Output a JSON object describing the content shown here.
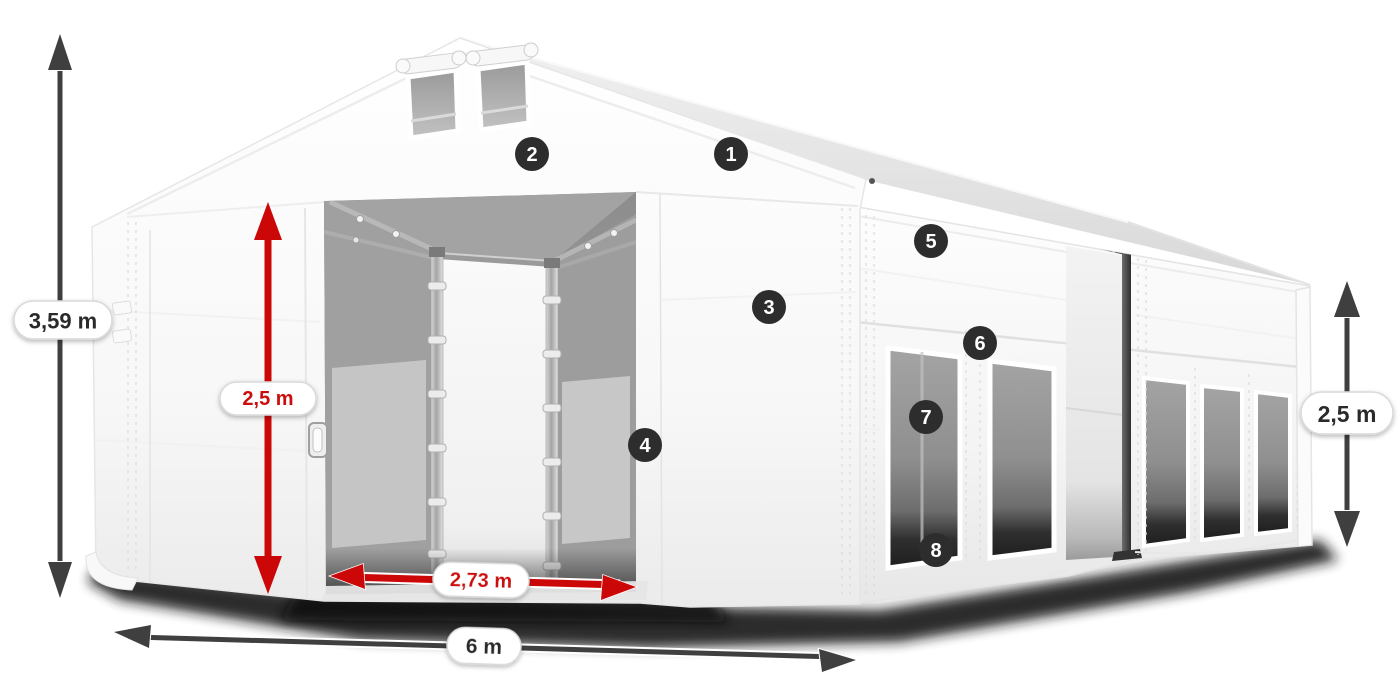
{
  "illustration": {
    "alt": "White gabled storage tent with open front entrance, sliding doors, mesh side windows, ventilation gable windows and dimension arrows",
    "colors": {
      "tent_white": "#f6f6f6",
      "interior_gray": "#a0a0a0",
      "mesh_gray": "#8e8e8e",
      "ground_shadow": "#141414",
      "dimension_red": "#cc0707",
      "dimension_dark": "#3f3f3f",
      "pill_background": "#ffffff",
      "pill_border": "#d9d9d9",
      "pill_text_dark": "#2b2b2b",
      "badge_background": "#2d2d2d",
      "badge_text": "#ffffff"
    },
    "dimensions": {
      "total_height": {
        "label": "3,59 m",
        "position": "left",
        "style": "dark",
        "orientation": "vertical"
      },
      "door_height": {
        "label": "2,5 m",
        "position": "entrance",
        "style": "red",
        "orientation": "vertical"
      },
      "door_width": {
        "label": "2,73 m",
        "position": "entrance-base",
        "style": "red",
        "orientation": "horizontal"
      },
      "length": {
        "label": "6 m",
        "position": "bottom-front",
        "style": "dark",
        "orientation": "horizontal"
      },
      "side_height": {
        "label": "2,5 m",
        "position": "right",
        "style": "dark",
        "orientation": "vertical"
      }
    },
    "callouts": {
      "c1": {
        "label": "1"
      },
      "c2": {
        "label": "2"
      },
      "c3": {
        "label": "3"
      },
      "c4": {
        "label": "4"
      },
      "c5": {
        "label": "5"
      },
      "c6": {
        "label": "6"
      },
      "c7": {
        "label": "7"
      },
      "c8": {
        "label": "8"
      }
    }
  }
}
